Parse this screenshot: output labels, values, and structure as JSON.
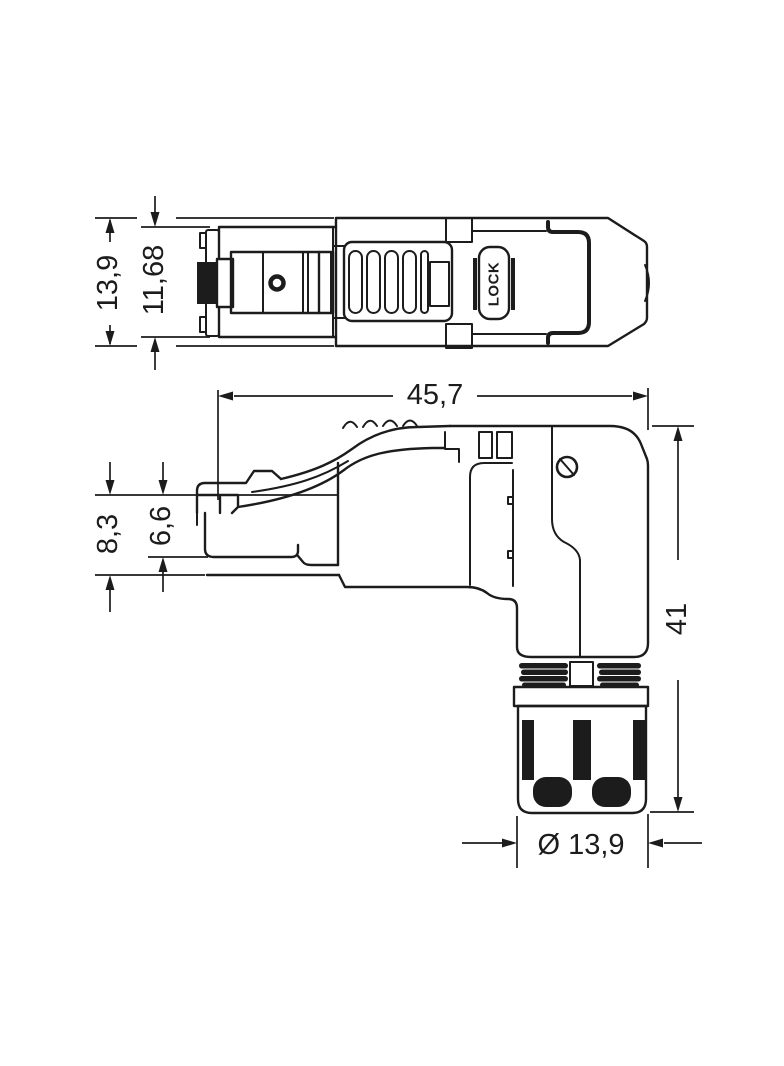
{
  "page": {
    "background_color": "#ffffff",
    "line_color": "#1c1c1c"
  },
  "drawing": {
    "kind": "dimensioned technical drawing of an angled RJ45 connector",
    "views": [
      {
        "id": "top-view",
        "description": "connector seen from above"
      },
      {
        "id": "side-view",
        "description": "connector seen from the side with angled cable gland"
      }
    ],
    "part_labels": {
      "lock": "LOCK"
    },
    "dimensions": [
      {
        "id": "top-overall-height",
        "view": "top-view",
        "label": "13,9",
        "orientation": "vertical"
      },
      {
        "id": "top-inner-height",
        "view": "top-view",
        "label": "11,68",
        "orientation": "vertical"
      },
      {
        "id": "overall-length",
        "view": "side-view",
        "label": "45,7",
        "orientation": "horizontal"
      },
      {
        "id": "plug-front-height",
        "view": "side-view",
        "label": "8,3",
        "orientation": "vertical"
      },
      {
        "id": "plug-inner-height",
        "view": "side-view",
        "label": "6,6",
        "orientation": "vertical"
      },
      {
        "id": "overall-height",
        "view": "side-view",
        "label": "41",
        "orientation": "vertical"
      },
      {
        "id": "cable-gland-diameter",
        "view": "side-view",
        "label": "Ø 13,9",
        "orientation": "horizontal"
      }
    ]
  }
}
